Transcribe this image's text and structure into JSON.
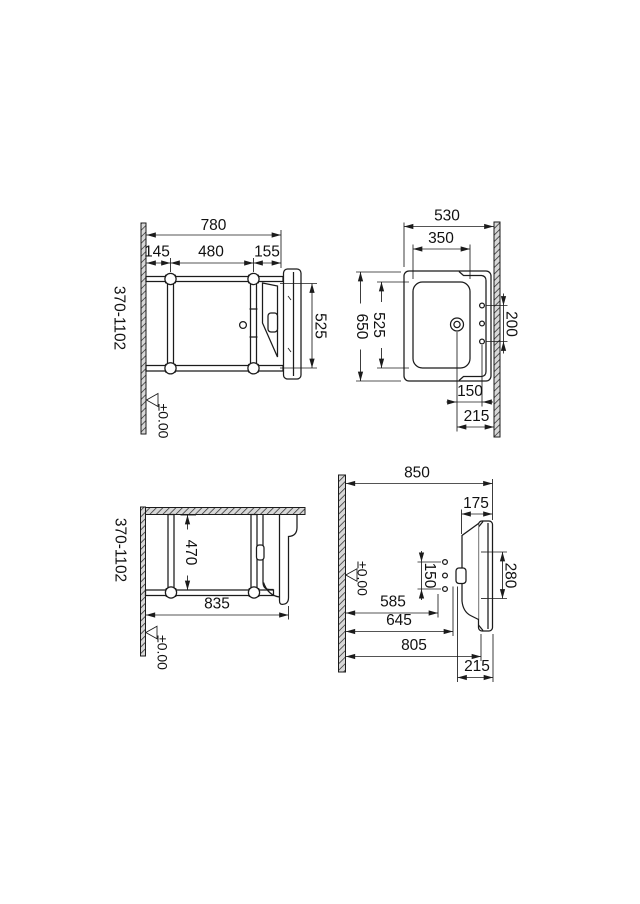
{
  "drawing": {
    "background": "#ffffff",
    "line_color": "#1b1b1b"
  },
  "frame_side": {
    "overall_width": "780",
    "offset_left": "145",
    "fixing_spacing": "480",
    "offset_right": "155",
    "basin_height": "525",
    "height_range": "370-1102",
    "datum": "±0.00"
  },
  "basin_plan": {
    "overall_width": "530",
    "bowl_width": "350",
    "overall_depth": "650",
    "bowl_depth": "525",
    "hole_spacing": "200",
    "drain_to_holes": "150",
    "drain_to_wall": "215"
  },
  "frame_plan": {
    "inner_span": "470",
    "overall_span": "835",
    "height_range": "370-1102",
    "datum": "±0.00"
  },
  "basin_side": {
    "overall": "850",
    "rim_depth": "175",
    "hole_spacing": "150",
    "fixing_span": "280",
    "wall_to_holes": "585",
    "wall_to_drain": "645",
    "wall_to_front": "805",
    "overhang": "215",
    "datum": "±0.00"
  }
}
